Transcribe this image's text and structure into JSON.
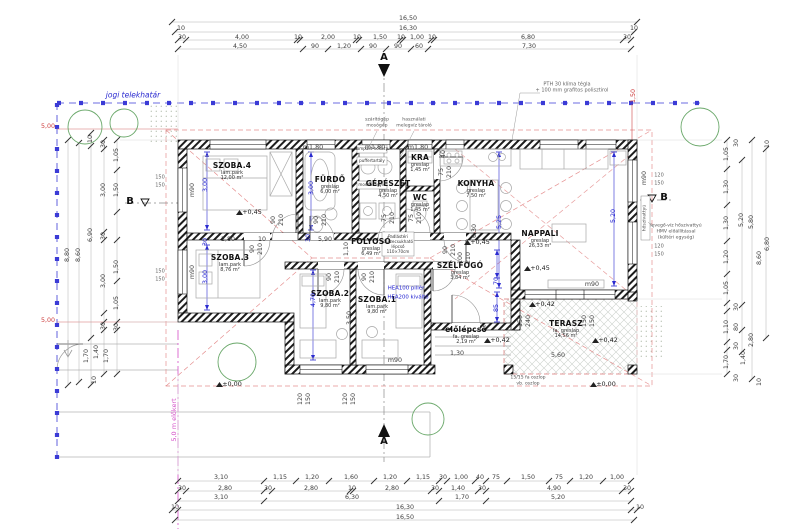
{
  "plan": {
    "boundary_label": "jogi telekhatár",
    "front_yard_label": "5,0 m előkert",
    "section_marker_a": "A",
    "section_marker_b": "B"
  },
  "rooms": [
    {
      "id": "szoba4",
      "name": "SZOBA.4",
      "floor": "lam.park",
      "area": "12,00 m²",
      "x": 232,
      "y": 172
    },
    {
      "id": "furdo",
      "name": "FÜRDŐ",
      "floor": "greslap",
      "area": "6,00 m²",
      "x": 330,
      "y": 186
    },
    {
      "id": "gepeszet",
      "name": "GÉPÉSZET",
      "floor": "greslap",
      "area": "4,50 m²",
      "x": 388,
      "y": 190
    },
    {
      "id": "kra",
      "name": "KRA",
      "floor": "greslap",
      "area": "1,45 m²",
      "x": 420,
      "y": 164
    },
    {
      "id": "wc",
      "name": "WC",
      "floor": "greslap",
      "area": "1,45 m²",
      "x": 420,
      "y": 204
    },
    {
      "id": "konyha",
      "name": "KONYHA",
      "floor": "greslap",
      "area": "7,50 m²",
      "x": 476,
      "y": 190
    },
    {
      "id": "nappali",
      "name": "NAPPALI",
      "floor": "greslap",
      "area": "26,33 m²",
      "x": 540,
      "y": 240
    },
    {
      "id": "folyoso",
      "name": "FOLYOSÓ",
      "floor": "greslap",
      "area": "6,49 m²",
      "x": 371,
      "y": 248
    },
    {
      "id": "szoba3",
      "name": "SZOBA.3",
      "floor": "lam.park",
      "area": "8,76 m²",
      "x": 230,
      "y": 264
    },
    {
      "id": "szoba2",
      "name": "SZOBA.2",
      "floor": "lam.park",
      "area": "9,80 m²",
      "x": 330,
      "y": 300
    },
    {
      "id": "szoba1",
      "name": "SZOBA.1",
      "floor": "lam.park",
      "area": "9,80 m²",
      "x": 377,
      "y": 306
    },
    {
      "id": "szelfogo",
      "name": "SZÉLFOGÓ",
      "floor": "greslap",
      "area": "3,84 m²",
      "x": 460,
      "y": 272
    },
    {
      "id": "elolepcso",
      "name": "előlépcső",
      "floor": "fa. greslap",
      "area": "2,19 m²",
      "x": 466,
      "y": 336
    },
    {
      "id": "terasz",
      "name": "TERASZ",
      "floor": "fa. greslap",
      "area": "14,56 m²",
      "x": 566,
      "y": 330
    }
  ],
  "labels": [
    {
      "t": "16,50",
      "x": 408,
      "y": 19,
      "c": "d"
    },
    {
      "t": "10",
      "x": 181,
      "y": 29,
      "c": "d"
    },
    {
      "t": "16,30",
      "x": 408,
      "y": 29,
      "c": "d"
    },
    {
      "t": "10",
      "x": 634,
      "y": 29,
      "c": "d"
    },
    {
      "t": "30",
      "x": 182,
      "y": 38,
      "c": "d"
    },
    {
      "t": "4,00",
      "x": 242,
      "y": 38,
      "c": "d"
    },
    {
      "t": "10",
      "x": 298,
      "y": 38,
      "c": "d"
    },
    {
      "t": "2,00",
      "x": 328,
      "y": 38,
      "c": "d"
    },
    {
      "t": "10",
      "x": 357,
      "y": 38,
      "c": "d"
    },
    {
      "t": "1,50",
      "x": 380,
      "y": 38,
      "c": "d"
    },
    {
      "t": "10",
      "x": 401,
      "y": 38,
      "c": "d"
    },
    {
      "t": "1,00",
      "x": 417,
      "y": 38,
      "c": "d"
    },
    {
      "t": "10",
      "x": 432,
      "y": 38,
      "c": "d"
    },
    {
      "t": "6,80",
      "x": 528,
      "y": 38,
      "c": "d"
    },
    {
      "t": "30",
      "x": 627,
      "y": 38,
      "c": "d"
    },
    {
      "t": "4,50",
      "x": 240,
      "y": 47,
      "c": "d"
    },
    {
      "t": "90",
      "x": 315,
      "y": 47,
      "c": "d"
    },
    {
      "t": "1,20",
      "x": 344,
      "y": 47,
      "c": "d"
    },
    {
      "t": "90",
      "x": 373,
      "y": 47,
      "c": "d"
    },
    {
      "t": "90",
      "x": 398,
      "y": 47,
      "c": "d"
    },
    {
      "t": "60",
      "x": 419,
      "y": 47,
      "c": "d"
    },
    {
      "t": "7,30",
      "x": 529,
      "y": 47,
      "c": "d"
    },
    {
      "t": "3,10",
      "x": 221,
      "y": 478,
      "c": "d"
    },
    {
      "t": "1,15",
      "x": 280,
      "y": 478,
      "c": "d"
    },
    {
      "t": "1,20",
      "x": 312,
      "y": 478,
      "c": "d"
    },
    {
      "t": "1,60",
      "x": 351,
      "y": 478,
      "c": "d"
    },
    {
      "t": "1,20",
      "x": 390,
      "y": 478,
      "c": "d"
    },
    {
      "t": "1,15",
      "x": 423,
      "y": 478,
      "c": "d"
    },
    {
      "t": "30",
      "x": 443,
      "y": 478,
      "c": "d"
    },
    {
      "t": "1,00",
      "x": 461,
      "y": 478,
      "c": "d"
    },
    {
      "t": "40",
      "x": 480,
      "y": 478,
      "c": "d"
    },
    {
      "t": "75",
      "x": 496,
      "y": 478,
      "c": "d"
    },
    {
      "t": "1,50",
      "x": 528,
      "y": 478,
      "c": "d"
    },
    {
      "t": "75",
      "x": 559,
      "y": 478,
      "c": "d"
    },
    {
      "t": "1,20",
      "x": 586,
      "y": 478,
      "c": "d"
    },
    {
      "t": "1,00",
      "x": 617,
      "y": 478,
      "c": "d"
    },
    {
      "t": "30",
      "x": 182,
      "y": 489,
      "c": "d"
    },
    {
      "t": "2,80",
      "x": 225,
      "y": 489,
      "c": "d"
    },
    {
      "t": "30",
      "x": 268,
      "y": 489,
      "c": "d"
    },
    {
      "t": "2,80",
      "x": 311,
      "y": 489,
      "c": "d"
    },
    {
      "t": "10",
      "x": 352,
      "y": 489,
      "c": "d"
    },
    {
      "t": "2,80",
      "x": 392,
      "y": 489,
      "c": "d"
    },
    {
      "t": "30",
      "x": 435,
      "y": 489,
      "c": "d"
    },
    {
      "t": "1,40",
      "x": 458,
      "y": 489,
      "c": "d"
    },
    {
      "t": "30",
      "x": 482,
      "y": 489,
      "c": "d"
    },
    {
      "t": "4,90",
      "x": 554,
      "y": 489,
      "c": "d"
    },
    {
      "t": "30",
      "x": 627,
      "y": 489,
      "c": "d"
    },
    {
      "t": "3,10",
      "x": 221,
      "y": 498,
      "c": "d"
    },
    {
      "t": "6,30",
      "x": 352,
      "y": 498,
      "c": "d"
    },
    {
      "t": "1,70",
      "x": 462,
      "y": 498,
      "c": "d"
    },
    {
      "t": "5,20",
      "x": 558,
      "y": 498,
      "c": "d"
    },
    {
      "t": "10",
      "x": 175,
      "y": 508,
      "c": "d"
    },
    {
      "t": "16,30",
      "x": 405,
      "y": 508,
      "c": "d"
    },
    {
      "t": "10",
      "x": 640,
      "y": 508,
      "c": "d"
    },
    {
      "t": "16,50",
      "x": 405,
      "y": 518,
      "c": "d"
    },
    {
      "t": "8,80",
      "x": 68,
      "y": 255,
      "c": "dv"
    },
    {
      "t": "8,60",
      "x": 79,
      "y": 255,
      "c": "dv"
    },
    {
      "t": "10",
      "x": 91,
      "y": 139,
      "c": "dv"
    },
    {
      "t": "6,90",
      "x": 91,
      "y": 235,
      "c": "dv"
    },
    {
      "t": "1,70",
      "x": 87,
      "y": 356,
      "c": "dv"
    },
    {
      "t": "1,40",
      "x": 97,
      "y": 352,
      "c": "dv"
    },
    {
      "t": "1,70",
      "x": 107,
      "y": 356,
      "c": "dv"
    },
    {
      "t": "30",
      "x": 104,
      "y": 144,
      "c": "dv"
    },
    {
      "t": "3,00",
      "x": 104,
      "y": 190,
      "c": "dv"
    },
    {
      "t": "30",
      "x": 104,
      "y": 236,
      "c": "dv"
    },
    {
      "t": "3,00",
      "x": 104,
      "y": 281,
      "c": "dv"
    },
    {
      "t": "30",
      "x": 104,
      "y": 326,
      "c": "dv"
    },
    {
      "t": "10",
      "x": 95,
      "y": 380,
      "c": "dv"
    },
    {
      "t": "1,05",
      "x": 117,
      "y": 155,
      "c": "dv"
    },
    {
      "t": "1,50",
      "x": 117,
      "y": 190,
      "c": "dv"
    },
    {
      "t": "1,50",
      "x": 117,
      "y": 267,
      "c": "dv"
    },
    {
      "t": "1,05",
      "x": 117,
      "y": 303,
      "c": "dv"
    },
    {
      "t": "30",
      "x": 117,
      "y": 327,
      "c": "dv"
    },
    {
      "t": "150",
      "x": 160,
      "y": 178,
      "c": "pp"
    },
    {
      "t": "150",
      "x": 160,
      "y": 186,
      "c": "pp"
    },
    {
      "t": "150",
      "x": 160,
      "y": 272,
      "c": "pp"
    },
    {
      "t": "150",
      "x": 160,
      "y": 280,
      "c": "pp"
    },
    {
      "t": "1,05",
      "x": 727,
      "y": 154,
      "c": "dv"
    },
    {
      "t": "1,30",
      "x": 727,
      "y": 187,
      "c": "dv"
    },
    {
      "t": "1,30",
      "x": 727,
      "y": 223,
      "c": "dv"
    },
    {
      "t": "1,20",
      "x": 727,
      "y": 257,
      "c": "dv"
    },
    {
      "t": "1,05",
      "x": 727,
      "y": 288,
      "c": "dv"
    },
    {
      "t": "1,10",
      "x": 727,
      "y": 327,
      "c": "dv"
    },
    {
      "t": "1,70",
      "x": 727,
      "y": 362,
      "c": "dv"
    },
    {
      "t": "30",
      "x": 737,
      "y": 143,
      "c": "dv"
    },
    {
      "t": "30",
      "x": 737,
      "y": 307,
      "c": "dv"
    },
    {
      "t": "80",
      "x": 737,
      "y": 327,
      "c": "dv"
    },
    {
      "t": "30",
      "x": 737,
      "y": 346,
      "c": "dv"
    },
    {
      "t": "1,40",
      "x": 744,
      "y": 358,
      "c": "dv"
    },
    {
      "t": "30",
      "x": 737,
      "y": 378,
      "c": "dv"
    },
    {
      "t": "5,20",
      "x": 742,
      "y": 220,
      "c": "dv"
    },
    {
      "t": "2,80",
      "x": 752,
      "y": 340,
      "c": "dv"
    },
    {
      "t": "5,80",
      "x": 752,
      "y": 222,
      "c": "dv"
    },
    {
      "t": "10",
      "x": 760,
      "y": 382,
      "c": "dv"
    },
    {
      "t": "8,60",
      "x": 760,
      "y": 258,
      "c": "dv"
    },
    {
      "t": "6,80",
      "x": 768,
      "y": 244,
      "c": "dv"
    },
    {
      "t": "10",
      "x": 768,
      "y": 144,
      "c": "dv"
    },
    {
      "t": "120",
      "x": 659,
      "y": 176,
      "c": "pp"
    },
    {
      "t": "150",
      "x": 659,
      "y": 184,
      "c": "pp"
    },
    {
      "t": "120",
      "x": 659,
      "y": 247,
      "c": "pp"
    },
    {
      "t": "150",
      "x": 659,
      "y": 255,
      "c": "pp"
    },
    {
      "t": "3,00",
      "x": 206,
      "y": 185,
      "c": "bv"
    },
    {
      "t": "3,00",
      "x": 312,
      "y": 188,
      "c": "bv"
    },
    {
      "t": "3,00",
      "x": 206,
      "y": 277,
      "c": "bv"
    },
    {
      "t": "30",
      "x": 206,
      "y": 242,
      "c": "bv"
    },
    {
      "t": "30",
      "x": 309,
      "y": 238,
      "c": "bv"
    },
    {
      "t": "4,70",
      "x": 314,
      "y": 300,
      "c": "bv"
    },
    {
      "t": "5,25",
      "x": 500,
      "y": 222,
      "c": "bv"
    },
    {
      "t": "5,20",
      "x": 614,
      "y": 216,
      "c": "bv"
    },
    {
      "t": "70",
      "x": 497,
      "y": 281,
      "c": "bv"
    },
    {
      "t": "85",
      "x": 497,
      "y": 308,
      "c": "bv"
    },
    {
      "t": "2,80",
      "x": 228,
      "y": 240,
      "c": "d"
    },
    {
      "t": "10",
      "x": 262,
      "y": 240,
      "c": "d"
    },
    {
      "t": "5,90",
      "x": 325,
      "y": 240,
      "c": "d"
    },
    {
      "t": "1,30",
      "x": 457,
      "y": 354,
      "c": "d"
    },
    {
      "t": "5,60",
      "x": 558,
      "y": 356,
      "c": "d"
    },
    {
      "t": "90",
      "x": 253,
      "y": 249,
      "c": "dv"
    },
    {
      "t": "210",
      "x": 261,
      "y": 249,
      "c": "dv"
    },
    {
      "t": "90",
      "x": 274,
      "y": 220,
      "c": "dv"
    },
    {
      "t": "210",
      "x": 282,
      "y": 220,
      "c": "dv"
    },
    {
      "t": "90",
      "x": 317,
      "y": 220,
      "c": "dv"
    },
    {
      "t": "210",
      "x": 325,
      "y": 220,
      "c": "dv"
    },
    {
      "t": "75",
      "x": 385,
      "y": 218,
      "c": "dv"
    },
    {
      "t": "210",
      "x": 393,
      "y": 218,
      "c": "dv"
    },
    {
      "t": "75",
      "x": 412,
      "y": 218,
      "c": "dv"
    },
    {
      "t": "210",
      "x": 420,
      "y": 218,
      "c": "dv"
    },
    {
      "t": "75",
      "x": 442,
      "y": 172,
      "c": "dv"
    },
    {
      "t": "210",
      "x": 450,
      "y": 172,
      "c": "dv"
    },
    {
      "t": "90",
      "x": 330,
      "y": 277,
      "c": "dv"
    },
    {
      "t": "210",
      "x": 338,
      "y": 277,
      "c": "dv"
    },
    {
      "t": "90",
      "x": 365,
      "y": 277,
      "c": "dv"
    },
    {
      "t": "210",
      "x": 373,
      "y": 277,
      "c": "dv"
    },
    {
      "t": "100",
      "x": 461,
      "y": 258,
      "c": "dv"
    },
    {
      "t": "210",
      "x": 469,
      "y": 258,
      "c": "dv"
    },
    {
      "t": "90",
      "x": 446,
      "y": 250,
      "c": "dv"
    },
    {
      "t": "210",
      "x": 454,
      "y": 250,
      "c": "dv"
    },
    {
      "t": "1,10",
      "x": 347,
      "y": 249,
      "c": "dv"
    },
    {
      "t": "3,50",
      "x": 350,
      "y": 318,
      "c": "dv"
    },
    {
      "t": "6,30",
      "x": 475,
      "y": 231,
      "c": "dv"
    },
    {
      "t": "40",
      "x": 444,
      "y": 154,
      "c": "dv"
    },
    {
      "t": "150",
      "x": 521,
      "y": 321,
      "c": "dv"
    },
    {
      "t": "240",
      "x": 529,
      "y": 321,
      "c": "dv"
    },
    {
      "t": "150",
      "x": 585,
      "y": 321,
      "c": "dv"
    },
    {
      "t": "150",
      "x": 593,
      "y": 321,
      "c": "dv"
    },
    {
      "t": "120",
      "x": 301,
      "y": 399,
      "c": "dv"
    },
    {
      "t": "150",
      "x": 309,
      "y": 399,
      "c": "dv"
    },
    {
      "t": "120",
      "x": 346,
      "y": 399,
      "c": "dv"
    },
    {
      "t": "150",
      "x": 354,
      "y": 399,
      "c": "dv"
    },
    {
      "t": "m1,80",
      "x": 313,
      "y": 148,
      "c": "d"
    },
    {
      "t": "m1,80",
      "x": 375,
      "y": 148,
      "c": "d"
    },
    {
      "t": "m1,80",
      "x": 418,
      "y": 148,
      "c": "d"
    },
    {
      "t": "m90",
      "x": 193,
      "y": 190,
      "c": "dv"
    },
    {
      "t": "m90",
      "x": 193,
      "y": 272,
      "c": "dv"
    },
    {
      "t": "m90",
      "x": 645,
      "y": 178,
      "c": "dv"
    },
    {
      "t": "m90",
      "x": 592,
      "y": 285,
      "c": "d"
    },
    {
      "t": "m90",
      "x": 395,
      "y": 361,
      "c": "d"
    },
    {
      "t": "+0,45",
      "x": 252,
      "y": 212,
      "c": "e"
    },
    {
      "t": "+0,45",
      "x": 480,
      "y": 242,
      "c": "e"
    },
    {
      "t": "+0,45",
      "x": 540,
      "y": 268,
      "c": "e"
    },
    {
      "t": "+0,42",
      "x": 500,
      "y": 340,
      "c": "e"
    },
    {
      "t": "+0,42",
      "x": 608,
      "y": 340,
      "c": "e"
    },
    {
      "t": "+0,42",
      "x": 545,
      "y": 304,
      "c": "e"
    },
    {
      "t": "±0,00",
      "x": 232,
      "y": 384,
      "c": "e"
    },
    {
      "t": "±0,00",
      "x": 606,
      "y": 384,
      "c": "e"
    },
    {
      "t": "5,00",
      "x": 48,
      "y": 127,
      "c": "rd"
    },
    {
      "t": "5,00",
      "x": 48,
      "y": 321,
      "c": "rd"
    },
    {
      "t": "1,50",
      "x": 634,
      "y": 96,
      "c": "rdv"
    },
    {
      "t": "5,0 m előkert",
      "x": 174,
      "y": 420,
      "c": "mg",
      "n": "front-yard-label"
    },
    {
      "t": "jogi telekhatár",
      "x": 133,
      "y": 95,
      "c": "bi",
      "n": "property-boundary-label"
    },
    {
      "t": "A",
      "x": 384,
      "y": 58,
      "c": "lt",
      "n": "section-marker-a-top"
    },
    {
      "t": "A",
      "x": 384,
      "y": 442,
      "c": "lt",
      "n": "section-marker-a-bottom"
    },
    {
      "t": "B",
      "x": 130,
      "y": 202,
      "c": "lt",
      "n": "section-marker-b-left"
    },
    {
      "t": "B",
      "x": 664,
      "y": 198,
      "c": "lt",
      "n": "section-marker-b-right"
    },
    {
      "t": "PTH 30 klíma tégla",
      "x": 567,
      "y": 85,
      "c": "nt",
      "n": "wall-note"
    },
    {
      "t": "+ 100 mm grafitos polisztirol",
      "x": 572,
      "y": 91,
      "c": "nt",
      "n": "wall-note"
    },
    {
      "t": "levegő-víz hőszivattyú",
      "x": 676,
      "y": 227,
      "c": "tn",
      "n": "heatpump-note"
    },
    {
      "t": "HMV előállítással",
      "x": 676,
      "y": 233,
      "c": "tn",
      "n": "heatpump-note"
    },
    {
      "t": "(kültéri egység)",
      "x": 676,
      "y": 239,
      "c": "tn",
      "n": "heatpump-note"
    },
    {
      "t": "hőszivattyú",
      "x": 646,
      "y": 218,
      "c": "tnv",
      "n": "heatpump-unit-label"
    },
    {
      "t": "15/15 fa oszlop",
      "x": 528,
      "y": 379,
      "c": "tn",
      "n": "post-note"
    },
    {
      "t": "vb. oszlop",
      "x": 528,
      "y": 385,
      "c": "tn",
      "n": "post-note"
    },
    {
      "t": "HEA100 pillér",
      "x": 406,
      "y": 289,
      "c": "bh",
      "n": "steel-note"
    },
    {
      "t": "HEA200 kiváltó",
      "x": 408,
      "y": 298,
      "c": "bh",
      "n": "steel-note"
    },
    {
      "t": "Padlástéri",
      "x": 398,
      "y": 237,
      "c": "bx",
      "n": "attic-stair-note"
    },
    {
      "t": "összecsukható",
      "x": 398,
      "y": 242,
      "c": "bx",
      "n": "attic-stair-note"
    },
    {
      "t": "lépcső",
      "x": 398,
      "y": 247,
      "c": "bx",
      "n": "attic-stair-note"
    },
    {
      "t": "110×70cm",
      "x": 398,
      "y": 252,
      "c": "bx",
      "n": "attic-stair-note"
    },
    {
      "t": "kompakt hőközp.",
      "x": 372,
      "y": 149,
      "c": "bx",
      "n": "mech-label"
    },
    {
      "t": "puffertartály",
      "x": 372,
      "y": 161,
      "c": "bx",
      "n": "mech-label"
    },
    {
      "t": "mosdókagyló",
      "x": 372,
      "y": 185,
      "c": "bx",
      "n": "mech-label"
    },
    {
      "t": "szárítógép",
      "x": 377,
      "y": 121,
      "c": "tn",
      "n": "appliance-note"
    },
    {
      "t": "mosógép",
      "x": 377,
      "y": 127,
      "c": "tn",
      "n": "appliance-note"
    },
    {
      "t": "használati",
      "x": 414,
      "y": 121,
      "c": "tn",
      "n": "hmv-note"
    },
    {
      "t": "melegvíz tároló",
      "x": 414,
      "y": 127,
      "c": "tn",
      "n": "hmv-note"
    }
  ]
}
